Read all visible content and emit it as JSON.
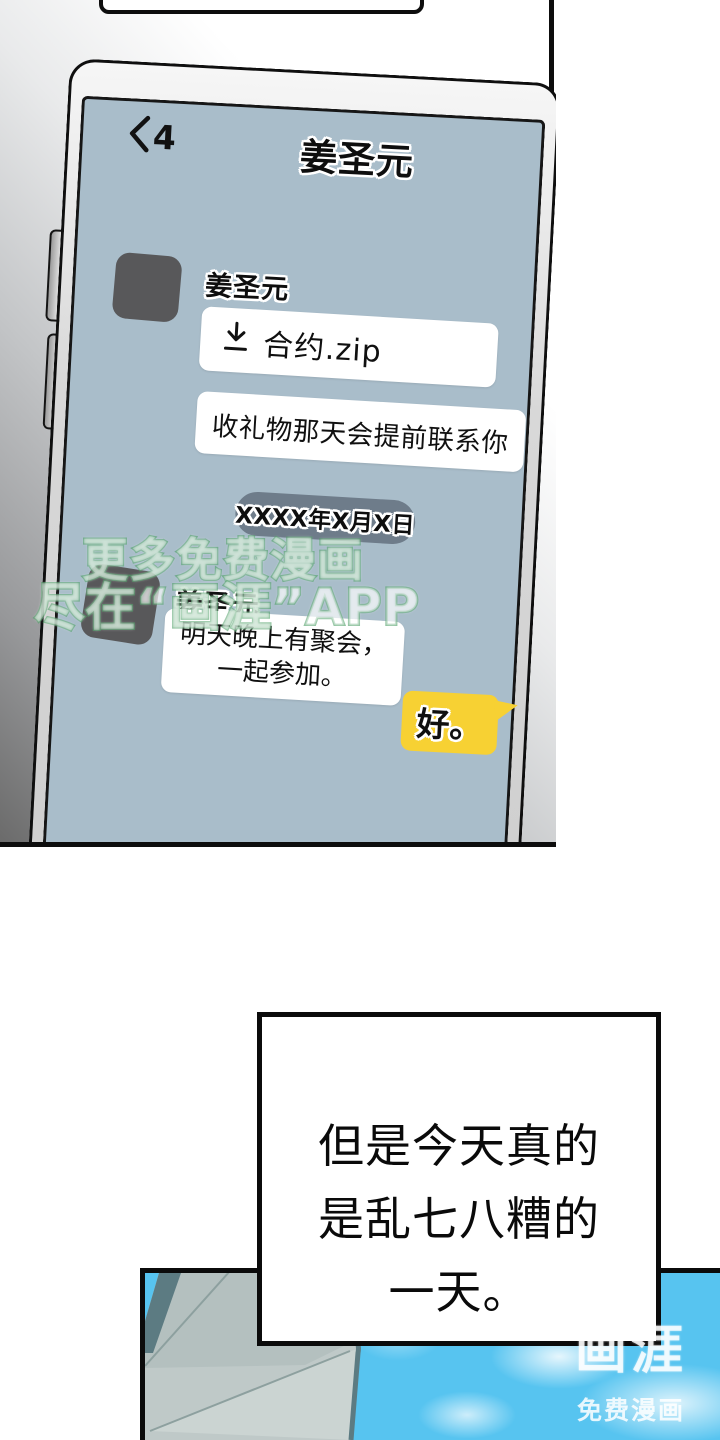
{
  "phone": {
    "back_count": "4",
    "title": "姜圣元",
    "msg1_sender": "姜圣元",
    "file_name": "合约.zip",
    "msg1_text": "收礼物那天会提前联系你",
    "date_divider": "XXXX年X月X日",
    "msg2_sender": "姜圣元",
    "msg2_line1": "明天晚上有聚会，",
    "msg2_line2": "一起参加。",
    "reply_text": "好。"
  },
  "watermark": {
    "line1": "更多免费漫画",
    "line2": "尽在“画涯”APP"
  },
  "narration": {
    "line1": "但是今天真的",
    "line2": "是乱七八糟的",
    "line3": "一天。"
  },
  "corner_watermark": {
    "logo": "画涯",
    "tagline": "免费漫画"
  },
  "colors": {
    "screen_bg": "#a9bdca",
    "reply_bubble_yellow": "#f7d133",
    "date_pill": "#6e7c8a",
    "avatar_gray": "#58585a",
    "sky_blue": "#57c4f0",
    "building_gray": "#bfc9c8",
    "watermark_green": "#43995e"
  }
}
